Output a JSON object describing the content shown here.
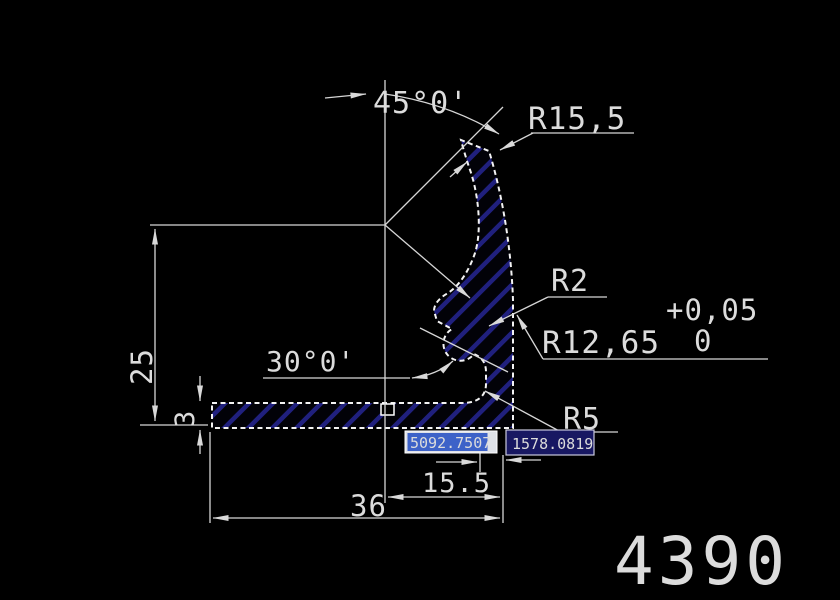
{
  "drawing": {
    "part_number": "4390",
    "dimensions": {
      "angle_top": "45°0'",
      "radius_top": "R15,5",
      "radius_small": "R2",
      "radius_main": "R12,65",
      "tolerance_upper": "+0,05",
      "tolerance_lower": "0",
      "angle_bottom": "30°0'",
      "radius_corner": "R5",
      "height": "25",
      "thickness": "3",
      "width_inner": "15.5",
      "width_total": "36"
    },
    "dynamic_input": {
      "field_x": "5092.7507",
      "field_y": "1578.0819"
    },
    "colors": {
      "background": "#000000",
      "dimension_line": "#d6d6d6",
      "profile_outline": "#f3f3f3",
      "hatch": "#20207e",
      "input_active_bg": "#dfe2e8",
      "input_selection": "#3d62c8",
      "input_field_bg": "#181862",
      "input_text": "#ffffff"
    }
  }
}
